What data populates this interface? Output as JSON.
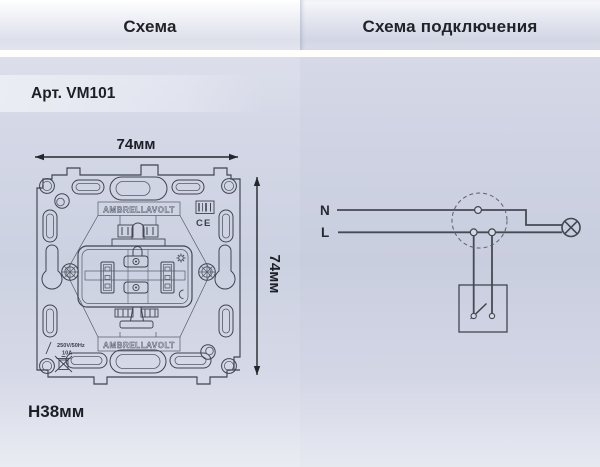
{
  "header": {
    "left_tab": "Схема",
    "right_tab": "Схема подключения"
  },
  "product": {
    "article": "Арт. VM101"
  },
  "dimensions": {
    "width": "74мм",
    "height": "74мм",
    "depth": "Н38мм"
  },
  "mechanism_drawing": {
    "brand": "AMBRELLAVOLT",
    "rating_voltage": "250V/50Hz",
    "rating_current": "10A",
    "ce_mark": "CE"
  },
  "wiring_diagram": {
    "neutral_label": "N",
    "line_label": "L"
  },
  "colors": {
    "panel_left_bg": "#ccd1e1",
    "panel_right_bg": "#c9cedf",
    "header_top": "#ffffff",
    "header_bottom": "#dde0ea",
    "separator": "#fffefd",
    "line_color": "#3f4350",
    "wire_color": "#474a54",
    "text_color": "#1d1f26"
  }
}
